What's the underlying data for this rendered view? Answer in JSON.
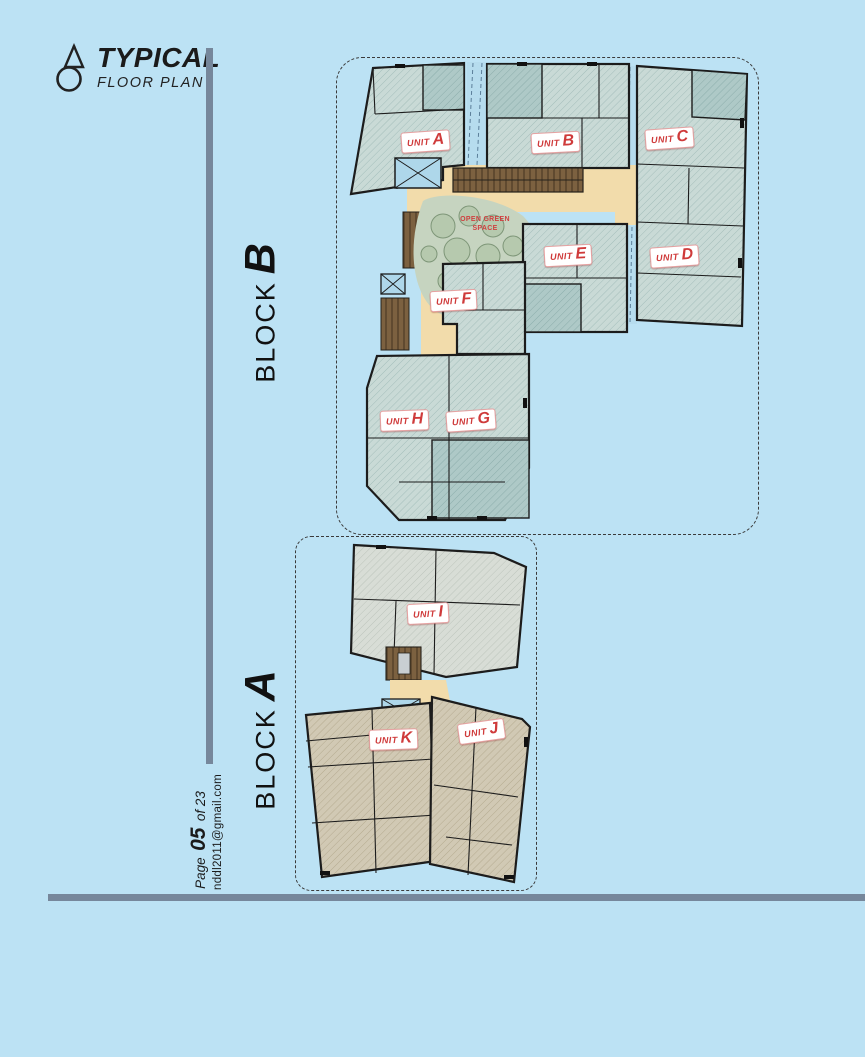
{
  "page": {
    "title": "TYPICAL",
    "subtitle": "FLOOR PLAN",
    "page_label": {
      "prefix": "Page",
      "number": "05",
      "suffix": "of 23"
    },
    "email": "nddl2011@gmail.com"
  },
  "blocks": {
    "b": {
      "word": "BLOCK",
      "letter": "B"
    },
    "a": {
      "word": "BLOCK",
      "letter": "A"
    }
  },
  "plan": {
    "unit_prefix": "UNIT",
    "units": [
      {
        "letter": "A"
      },
      {
        "letter": "B"
      },
      {
        "letter": "C"
      },
      {
        "letter": "D"
      },
      {
        "letter": "E"
      },
      {
        "letter": "F"
      },
      {
        "letter": "G"
      },
      {
        "letter": "H"
      },
      {
        "letter": "I"
      },
      {
        "letter": "J"
      },
      {
        "letter": "K"
      }
    ],
    "green_space": {
      "line1": "OPEN GREEN",
      "line2": "SPACE"
    }
  },
  "colors": {
    "background": "#bce2f4",
    "accent_red": "#cf3a3a",
    "bar_gray": "#76879b",
    "wall": "#1c1c1c",
    "room_teal": "#c9dad6",
    "room_teal_dark": "#aec9c7",
    "room_gray": "#d8ddd6",
    "room_tan": "#d1c9b4",
    "corridor_beige": "#f2dcab",
    "shaft_blue": "#aed7ea",
    "stairs_brown": "#7c6140",
    "green_space": "#c6d4c0"
  }
}
